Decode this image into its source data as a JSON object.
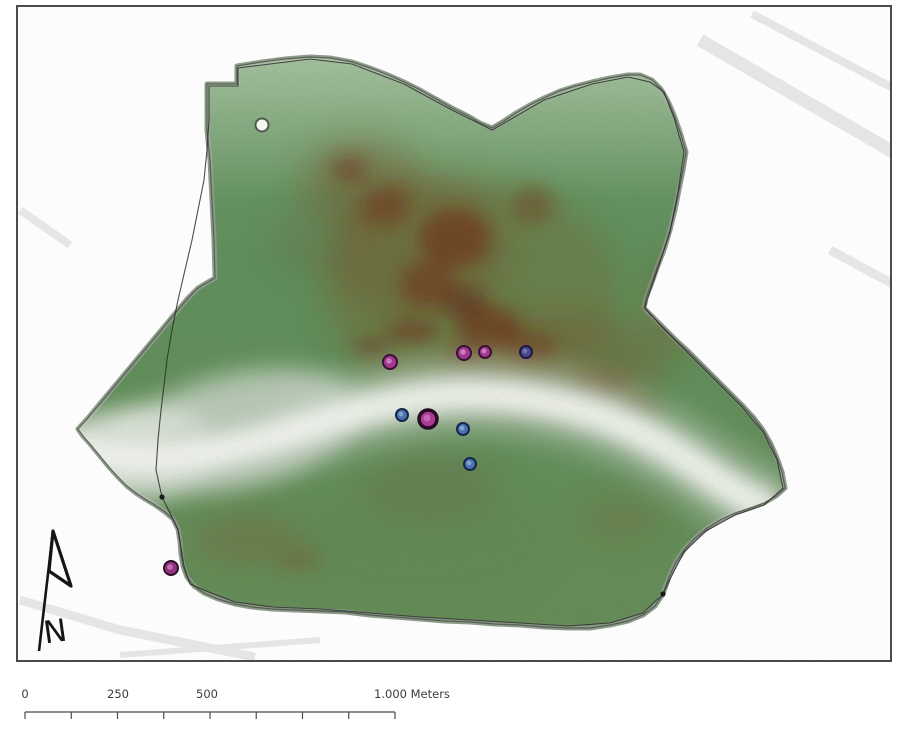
{
  "map": {
    "title": "kernel-density-surface-map",
    "scalebar": {
      "labels": [
        "0",
        "250",
        "500",
        "1.000 Meters"
      ],
      "x_start": 25,
      "x_end": 395,
      "y": 712,
      "segments": 8,
      "tick_height": 7,
      "line_color": "#4a4a4a",
      "text_color": "#3c3c3c"
    },
    "north_arrow": {
      "label": "N"
    },
    "frame": {
      "border_color": "#4b4b4b"
    },
    "surface": {
      "ramp_low_to_high": [
        "#f1f3ee",
        "#c2cfc3",
        "#5e8e5c",
        "#7a5526",
        "#6e2f18"
      ],
      "base_green": "#5e8e5c",
      "hotspots_broad": [
        {
          "x": 470,
          "y": 290,
          "rx": 150,
          "ry": 110,
          "color": "#7a5a28",
          "opacity": 0.28
        },
        {
          "x": 420,
          "y": 250,
          "rx": 90,
          "ry": 80,
          "color": "#7a4a22",
          "opacity": 0.3
        },
        {
          "x": 560,
          "y": 360,
          "rx": 110,
          "ry": 50,
          "color": "#7a4a22",
          "opacity": 0.3
        },
        {
          "x": 360,
          "y": 180,
          "rx": 60,
          "ry": 45,
          "color": "#7a4a22",
          "opacity": 0.3
        },
        {
          "x": 320,
          "y": 240,
          "rx": 50,
          "ry": 40,
          "color": "#6f5a30",
          "opacity": 0.2
        },
        {
          "x": 430,
          "y": 490,
          "rx": 70,
          "ry": 35,
          "color": "#6f5530",
          "opacity": 0.22
        },
        {
          "x": 250,
          "y": 540,
          "rx": 55,
          "ry": 25,
          "color": "#7a5228",
          "opacity": 0.3
        },
        {
          "x": 620,
          "y": 520,
          "rx": 40,
          "ry": 22,
          "color": "#7a5228",
          "opacity": 0.22
        },
        {
          "x": 680,
          "y": 300,
          "rx": 35,
          "ry": 50,
          "color": "#7a4a22",
          "opacity": 0.25
        },
        {
          "x": 150,
          "y": 448,
          "rx": 22,
          "ry": 14,
          "color": "#8a5a28",
          "opacity": 0.35
        },
        {
          "x": 420,
          "y": 540,
          "rx": 130,
          "ry": 60,
          "color": "#5f7f4a",
          "opacity": 0.25
        }
      ],
      "hotspots_core": [
        {
          "x": 455,
          "y": 238,
          "rx": 36,
          "ry": 30,
          "color": "#6e2f18",
          "opacity": 0.6
        },
        {
          "x": 428,
          "y": 284,
          "rx": 28,
          "ry": 24,
          "color": "#6e2f18",
          "opacity": 0.55
        },
        {
          "x": 490,
          "y": 328,
          "rx": 32,
          "ry": 22,
          "color": "#6e2f18",
          "opacity": 0.6
        },
        {
          "x": 465,
          "y": 303,
          "rx": 22,
          "ry": 18,
          "color": "#5f2412",
          "opacity": 0.5
        },
        {
          "x": 530,
          "y": 348,
          "rx": 26,
          "ry": 16,
          "color": "#6e2f18",
          "opacity": 0.5
        },
        {
          "x": 385,
          "y": 206,
          "rx": 24,
          "ry": 20,
          "color": "#6e2f18",
          "opacity": 0.45
        },
        {
          "x": 350,
          "y": 170,
          "rx": 20,
          "ry": 15,
          "color": "#6e2f18",
          "opacity": 0.45
        },
        {
          "x": 533,
          "y": 205,
          "rx": 22,
          "ry": 20,
          "color": "#74381c",
          "opacity": 0.4
        },
        {
          "x": 600,
          "y": 385,
          "rx": 28,
          "ry": 16,
          "color": "#74381c",
          "opacity": 0.4
        },
        {
          "x": 640,
          "y": 408,
          "rx": 22,
          "ry": 13,
          "color": "#74381c",
          "opacity": 0.35
        },
        {
          "x": 412,
          "y": 332,
          "rx": 26,
          "ry": 13,
          "color": "#6e2f18",
          "opacity": 0.5
        },
        {
          "x": 372,
          "y": 347,
          "rx": 20,
          "ry": 11,
          "color": "#6e2f18",
          "opacity": 0.4
        },
        {
          "x": 300,
          "y": 560,
          "rx": 22,
          "ry": 11,
          "color": "#7a4420",
          "opacity": 0.3
        },
        {
          "x": 463,
          "y": 352,
          "rx": 18,
          "ry": 10,
          "color": "#6e2f18",
          "opacity": 0.4
        }
      ],
      "light_patches": [
        {
          "x": 240,
          "y": 428,
          "rx": 120,
          "ry": 55,
          "rot": -12,
          "color": "#cfd8cf",
          "opacity": 0.75
        },
        {
          "x": 150,
          "y": 450,
          "rx": 62,
          "ry": 45,
          "rot": 0,
          "color": "#e6ebe5",
          "opacity": 0.85
        },
        {
          "x": 110,
          "y": 452,
          "rx": 48,
          "ry": 34,
          "rot": 0,
          "color": "#f3f5f1",
          "opacity": 0.9
        }
      ]
    },
    "markers": [
      {
        "category": "white-reference-point",
        "x": 262,
        "y": 125,
        "r": 6.5,
        "fill": "#f3f8f0",
        "stroke": "#4e5a4e",
        "sw": 2,
        "center": null
      },
      {
        "category": "magenta-point",
        "x": 390,
        "y": 362,
        "r": 7,
        "fill": "#a1388f",
        "stroke": "#3a1034",
        "sw": 2,
        "center": "#cc86c2"
      },
      {
        "category": "magenta-point",
        "x": 464,
        "y": 353,
        "r": 7,
        "fill": "#a1388f",
        "stroke": "#3a1034",
        "sw": 2,
        "center": "#cc86c2"
      },
      {
        "category": "magenta-point",
        "x": 485,
        "y": 352,
        "r": 6,
        "fill": "#a1388f",
        "stroke": "#3a1034",
        "sw": 2,
        "center": "#cc86c2"
      },
      {
        "category": "blue-violet-point",
        "x": 526,
        "y": 352,
        "r": 6,
        "fill": "#444a8a",
        "stroke": "#1f1640",
        "sw": 2,
        "center": "#7d74b0"
      },
      {
        "category": "blue-point",
        "x": 402,
        "y": 415,
        "r": 6,
        "fill": "#4a73ad",
        "stroke": "#15264d",
        "sw": 2,
        "center": "#86a8d2"
      },
      {
        "category": "magenta-point-large",
        "x": 428,
        "y": 419,
        "r": 9,
        "fill": "#a83a95",
        "stroke": "#250b23",
        "sw": 3.5,
        "center": "#c66ab5"
      },
      {
        "category": "blue-point",
        "x": 463,
        "y": 429,
        "r": 6,
        "fill": "#4a73ad",
        "stroke": "#15264d",
        "sw": 2,
        "center": "#86a8d2"
      },
      {
        "category": "blue-point",
        "x": 470,
        "y": 464,
        "r": 6,
        "fill": "#4a73ad",
        "stroke": "#15264d",
        "sw": 2,
        "center": "#86a8d2"
      },
      {
        "category": "magenta-point",
        "x": 171,
        "y": 568,
        "r": 7,
        "fill": "#933480",
        "stroke": "#2e0f2a",
        "sw": 2,
        "center": "#c279b2"
      }
    ],
    "boundary_nodes": [
      {
        "x": 162,
        "y": 497
      },
      {
        "x": 663,
        "y": 594
      }
    ]
  }
}
